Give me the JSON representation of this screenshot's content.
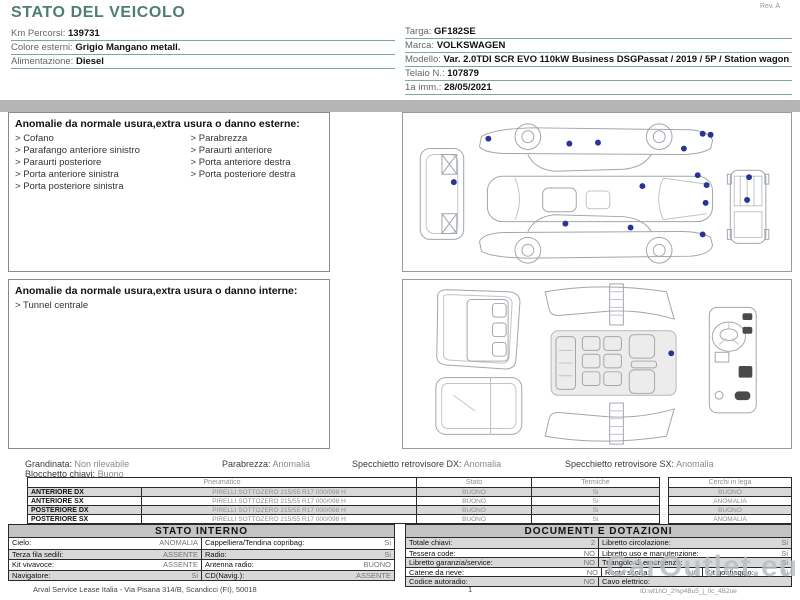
{
  "header": {
    "title": "STATO DEL VEICOLO",
    "rev": "Rev. A",
    "left_fields": [
      {
        "label": "Km Percorsi:",
        "value": "139731"
      },
      {
        "label": "Colore esterni:",
        "value": "Grigio Mangano metall."
      },
      {
        "label": "Alimentazione:",
        "value": "Diesel"
      }
    ],
    "right_fields": [
      {
        "label": "Targa:",
        "value": "GF182SE"
      },
      {
        "label": "Marca:",
        "value": "VOLKSWAGEN"
      },
      {
        "label": "Modello:",
        "value": "Var. 2.0TDI SCR EVO 110kW Business DSGPassat / 2019 / 5P / Station wagon"
      },
      {
        "label": "Telaio N.:",
        "value": "107879"
      },
      {
        "label": "1a imm.:",
        "value": "28/05/2021"
      }
    ]
  },
  "exterior_section": {
    "title": "Anomalie da normale usura,extra usura o danno esterne:",
    "items_left": [
      "Cofano",
      "Parafango anteriore sinistro",
      "Paraurti posteriore",
      "Porta anteriore sinistra",
      "Porta posteriore sinistra"
    ],
    "items_right": [
      "Parabrezza",
      "Paraurti anteriore",
      "Porta anteriore destra",
      "Porta posteriore destra"
    ]
  },
  "interior_section": {
    "title": "Anomalie da normale usura,extra usura o danno interne:",
    "items_left": [
      "Tunnel centrale"
    ]
  },
  "exterior_damage_points": [
    [
      85,
      26
    ],
    [
      167,
      31
    ],
    [
      196,
      30
    ],
    [
      283,
      36
    ],
    [
      302,
      21
    ],
    [
      310,
      22
    ],
    [
      50,
      70
    ],
    [
      297,
      63
    ],
    [
      306,
      73
    ],
    [
      241,
      74
    ],
    [
      305,
      91
    ],
    [
      349,
      65
    ],
    [
      347,
      88
    ],
    [
      163,
      112
    ],
    [
      229,
      116
    ],
    [
      302,
      123
    ]
  ],
  "interior_damage_points": [
    [
      271,
      75
    ]
  ],
  "summary": {
    "grandinata": {
      "label": "Grandinata:",
      "value": "Non rilevabile"
    },
    "parabrezza": {
      "label": "Parabrezza:",
      "value": "Anomalia"
    },
    "specchietto_dx": {
      "label": "Specchietto retrovisore DX:",
      "value": "Anomalia"
    },
    "specchietto_sx": {
      "label": "Specchietto retrovisore SX:",
      "value": "Anomalia"
    },
    "blocchetto": {
      "label": "Blocchetto chiavi:",
      "value": "Buono"
    }
  },
  "tyres": {
    "headers": {
      "pneumatico": "Pneumatico",
      "stato": "Stato",
      "termiche": "Termiche",
      "cerchi": "Cerchi in lega"
    },
    "rows": [
      {
        "position": "ANTERIORE DX",
        "tyre": "PIRELLI SOTTOZERO 215/55 R17 000/098 H",
        "stato": "BUONO",
        "termiche": "Si",
        "cerchi": "BUONO"
      },
      {
        "position": "ANTERIORE SX",
        "tyre": "PIRELLI SOTTOZERO 215/55 R17 000/098 H",
        "stato": "BUONO",
        "termiche": "Si",
        "cerchi": "ANOMALIA"
      },
      {
        "position": "POSTERIORE DX",
        "tyre": "PIRELLI SOTTOZERO 215/55 R17 000/098 H",
        "stato": "BUONO",
        "termiche": "Si",
        "cerchi": "BUONO"
      },
      {
        "position": "POSTERIORE SX",
        "tyre": "PIRELLI SOTTOZERO 215/55 R17 000/098 H",
        "stato": "BUONO",
        "termiche": "Si",
        "cerchi": "ANOMALIA"
      }
    ]
  },
  "stato_interno": {
    "title": "STATO INTERNO",
    "rows": [
      [
        {
          "label": "Cielo:",
          "value": "ANOMALIA"
        },
        {
          "label": "Cappelliera/Tendina copribag:",
          "value": "Si"
        }
      ],
      [
        {
          "label": "Terza fila sedili:",
          "value": "ASSENTE"
        },
        {
          "label": "Radio:",
          "value": "Si"
        }
      ],
      [
        {
          "label": "Kit vivavoce:",
          "value": "ASSENTE"
        },
        {
          "label": "Antenna radio:",
          "value": "BUONO"
        }
      ],
      [
        {
          "label": "Navigatore:",
          "value": "Si"
        },
        {
          "label": "CD(Navig.):",
          "value": "ASSENTE"
        }
      ]
    ]
  },
  "documenti": {
    "title": "DOCUMENTI E DOTAZIONI",
    "rows": [
      [
        {
          "label": "Totale chiavi:",
          "value": "2"
        },
        {
          "label": "Libretto circolazione:",
          "value": "Si"
        }
      ],
      [
        {
          "label": "Tessera code:",
          "value": "NO"
        },
        {
          "label": "Libretto uso e manutenzione:",
          "value": "Si"
        }
      ],
      [
        {
          "label": "Libretto garanzia/service:",
          "value": "NO"
        },
        {
          "label": "Triangolo di emergenza:",
          "value": "Si"
        }
      ],
      [
        {
          "label": "Catene da neve:",
          "value": "NO"
        },
        {
          "label": "Ruota scorta:",
          "value": "NO"
        },
        {
          "label": "Kit gonfiaggio:",
          "value": "Si"
        }
      ],
      [
        {
          "label": "Codice autoradio:",
          "value": "NO"
        },
        {
          "label": "Cavo elettrico:",
          "value": ""
        }
      ]
    ]
  },
  "footer": {
    "company": "Arval Service Lease Italia - Via Pisana 314/B, Scandicci (FI), 50018",
    "page": "1",
    "watermark": "CarOutlet.eu",
    "doc_id": "ID:wf1hO_2%p4Bu5_j_0c_4B2ue"
  },
  "colors": {
    "accent_teal": "#4e7e72",
    "damage_dot": "#283593",
    "divider_bar": "#b5b5b5",
    "row_stripe": "#d9d9d9",
    "watermark_gray": "#b7bdc2"
  }
}
